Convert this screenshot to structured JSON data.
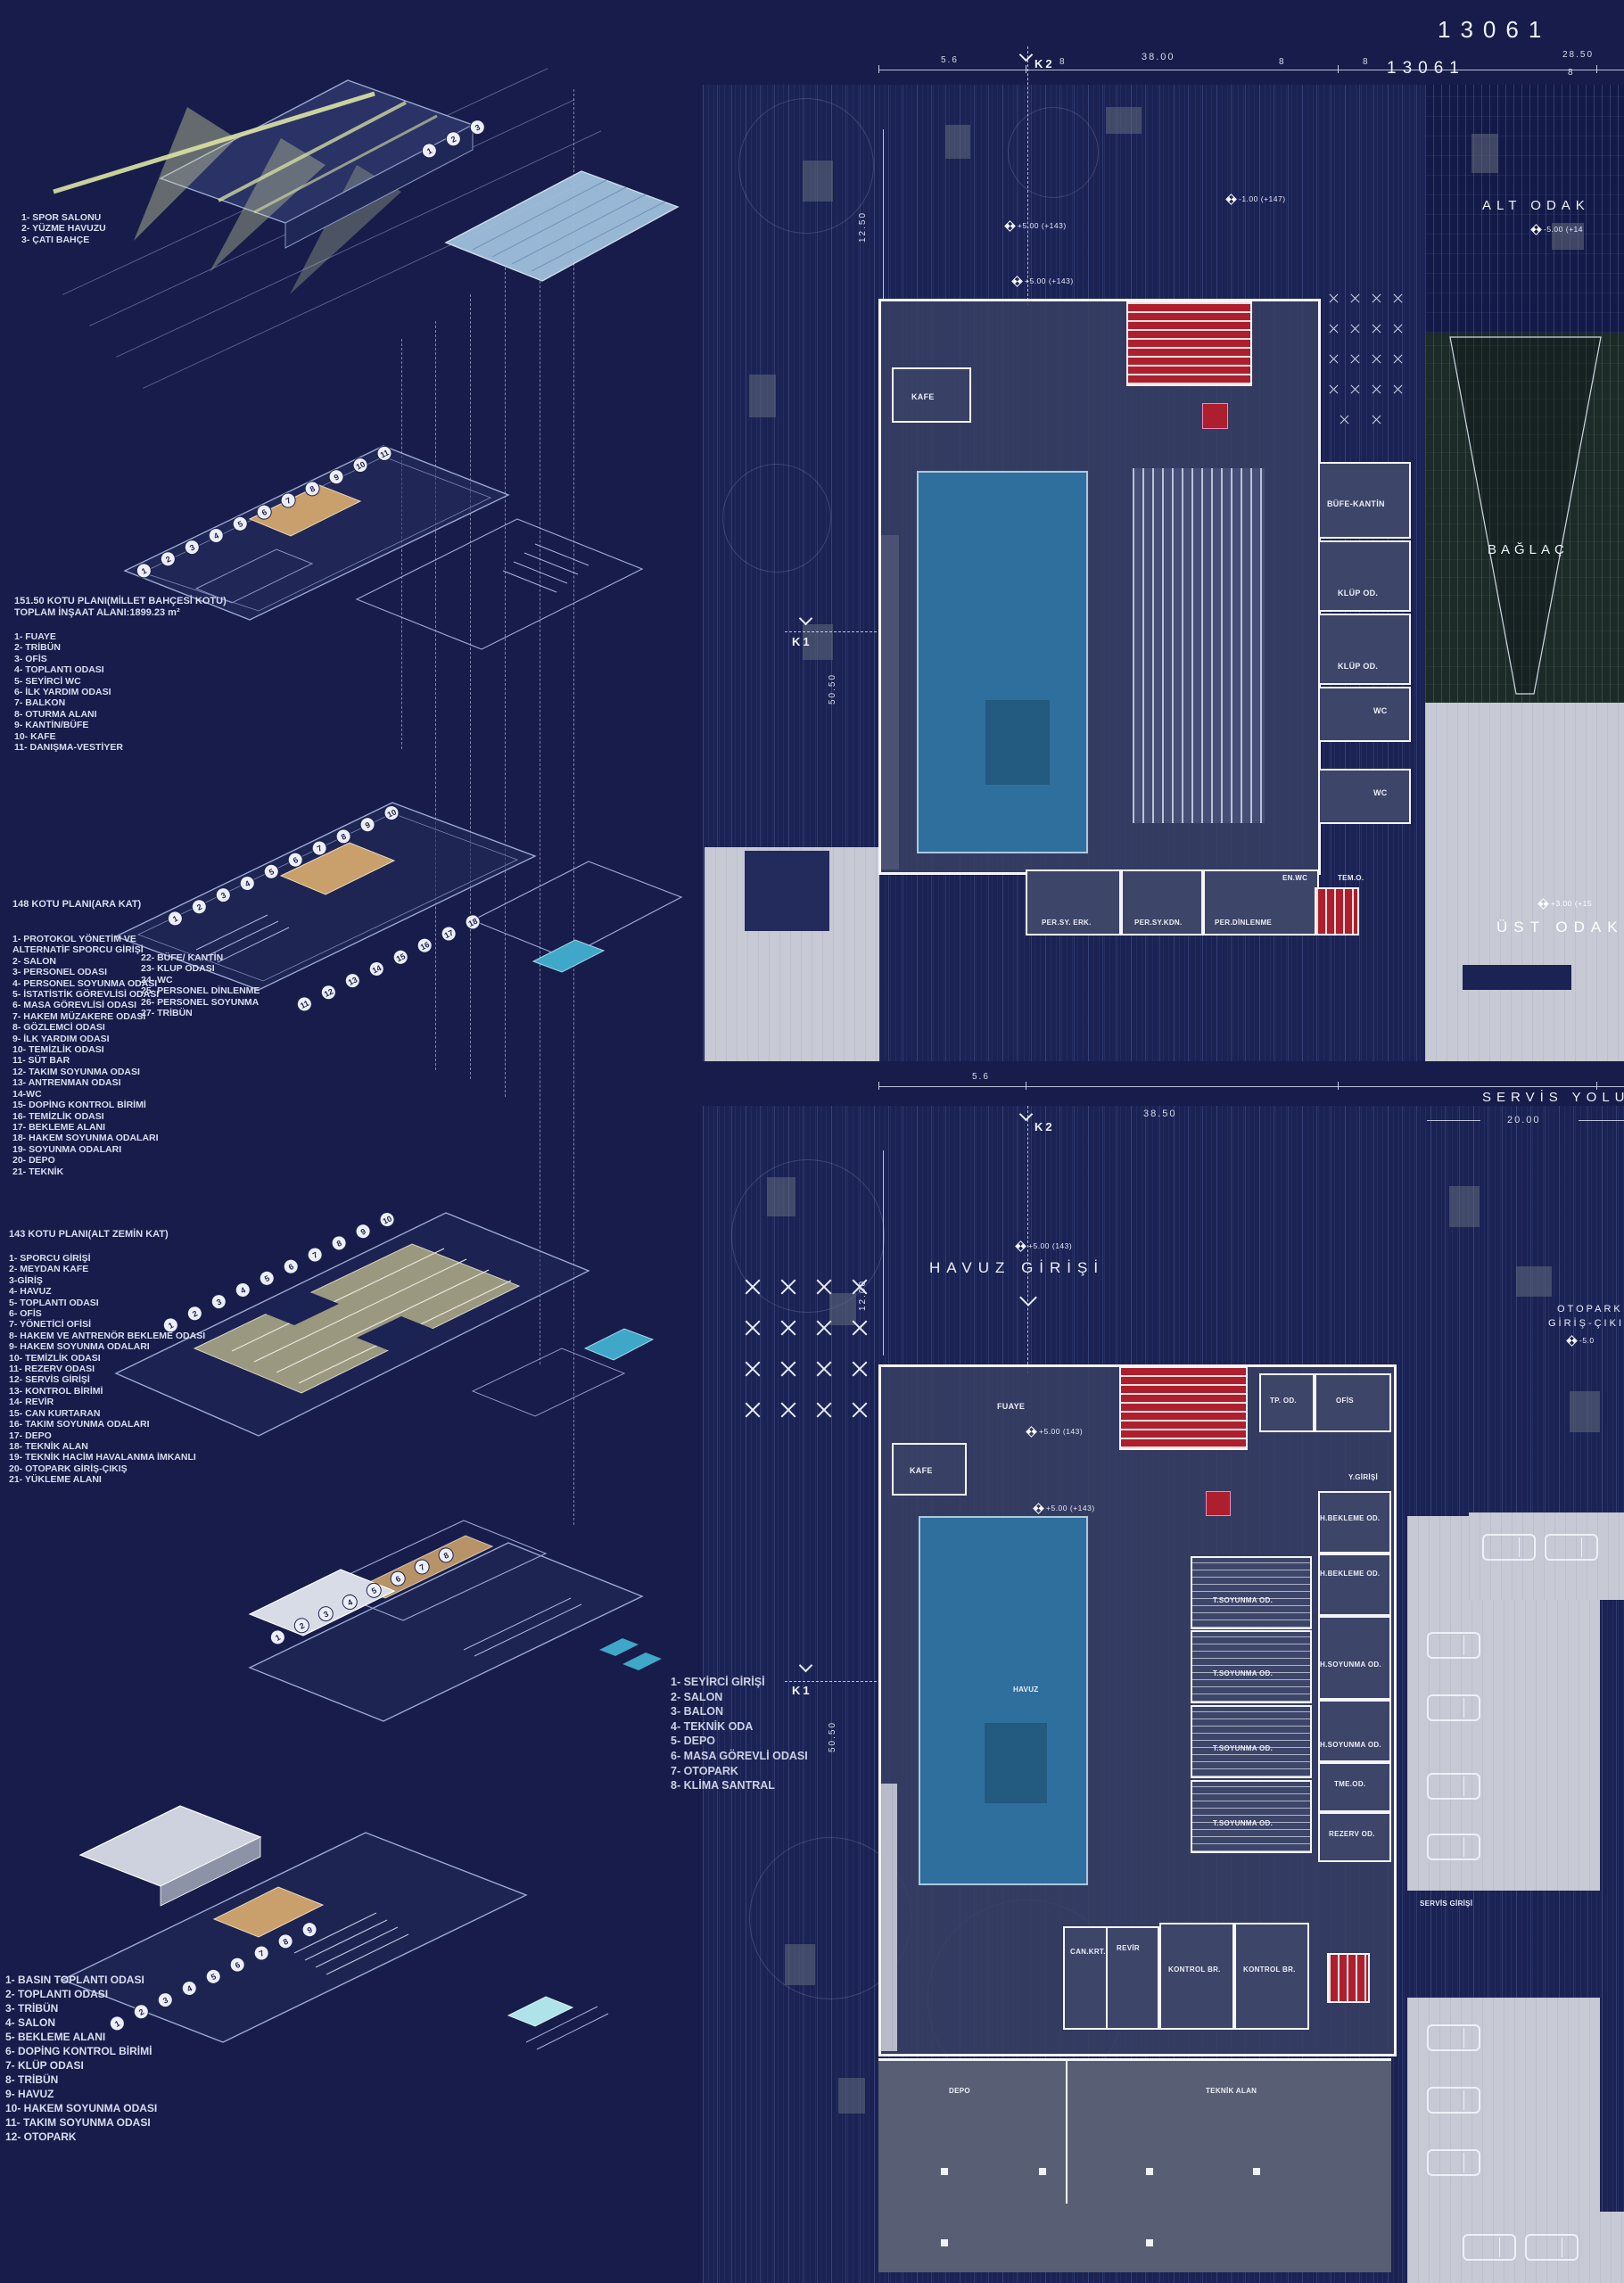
{
  "board": {
    "number_large": "13061",
    "number_small": "13061"
  },
  "icons": {
    "level_marker": "survey-diamond",
    "k_marker_arrow": "chevron-down",
    "tree": "cross-flower",
    "car": "car-outline"
  },
  "left": {
    "list_roof": [
      "1- SPOR SALONU",
      "2- YÜZME HAVUZU",
      "3- ÇATI BAHÇE"
    ],
    "list_151": {
      "title1": "151.50 KOTU PLANI(MİLLET BAHÇESİ KOTU)",
      "title2": "TOPLAM İNŞAAT ALANI:1899.23 m²",
      "items": [
        "1- FUAYE",
        "2- TRİBÜN",
        "3- OFİS",
        "4- TOPLANTI ODASI",
        "5- SEYİRCİ WC",
        "6- İLK YARDIM ODASI",
        "7- BALKON",
        "8- OTURMA ALANI",
        "9- KANTİN/BÜFE",
        "10- KAFE",
        "11- DANIŞMA-VESTİYER"
      ]
    },
    "list_148": {
      "title": "148 KOTU PLANI(ARA KAT)",
      "col1": [
        "1- PROTOKOL YÖNETİM VE",
        "ALTERNATİF SPORCU GİRİŞİ",
        "2- SALON",
        "3- PERSONEL ODASI",
        "4- PERSONEL SOYUNMA ODASI",
        "5- İSTATİSTİK GÖREVLİSİ ODASI",
        "6- MASA GÖREVLİSİ ODASI",
        "7- HAKEM MÜZAKERE ODASI",
        "8- GÖZLEMCİ ODASI",
        "9- İLK YARDIM ODASI",
        "10- TEMİZLİK ODASI",
        "11- SÜT BAR",
        "12- TAKIM SOYUNMA ODASI",
        "13- ANTRENMAN ODASI",
        "14-WC",
        "15- DOPİNG KONTROL BİRİMİ",
        "16- TEMİZLİK ODASI",
        "17- BEKLEME ALANI",
        "18- HAKEM SOYUNMA ODALARI",
        "19- SOYUNMA ODALARI",
        "20- DEPO",
        "21- TEKNİK"
      ],
      "col2": [
        "22- BÜFE/ KANTİN",
        "23- KLUP ODASI",
        "24- WC",
        "25- PERSONEL DİNLENME",
        "26- PERSONEL SOYUNMA",
        "27- TRİBÜN"
      ]
    },
    "list_143": {
      "title": "143 KOTU PLANI(ALT ZEMİN KAT)",
      "items": [
        "1- SPORCU GİRİŞİ",
        "2- MEYDAN KAFE",
        "3-GİRİŞ",
        "4- HAVUZ",
        "5- TOPLANTI ODASI",
        "6- OFİS",
        "7- YÖNETİCİ OFİSİ",
        "8- HAKEM VE ANTRENÖR BEKLEME ODASI",
        "9- HAKEM SOYUNMA ODALARI",
        "10- TEMİZLİK ODASI",
        "11- REZERV ODASI",
        "12-  SERVİS GİRİŞİ",
        "13- KONTROL BİRİMİ",
        "14- REVİR",
        "15- CAN KURTARAN",
        "16- TAKIM SOYUNMA ODALARI",
        "17- DEPO",
        "18- TEKNİK ALAN",
        "19- TEKNİK HACİM HAVALANMA İMKANLI",
        "20- OTOPARK GİRİŞ-ÇIKIŞ",
        "21- YÜKLEME ALANI"
      ]
    },
    "list_bottom": [
      "1- BASIN TOPLANTI ODASI",
      "2- TOPLANTI ODASI",
      "3- TRİBÜN",
      "4- SALON",
      "5- BEKLEME ALANI",
      "6- DOPİNG KONTROL BİRİMİ",
      "7- KLÜP ODASI",
      "8- TRİBÜN",
      "9- HAVUZ",
      "10- HAKEM SOYUNMA ODASI",
      "11- TAKIM SOYUNMA ODASI",
      "12- OTOPARK"
    ],
    "list_section": [
      "1- SEYİRCİ GİRİŞİ",
      "2- SALON",
      "3- BALON",
      "4- TEKNİK ODA",
      "5- DEPO",
      "6- MASA GÖREVLİ ODASI",
      "7- OTOPARK",
      "8- KLİMA SANTRAL"
    ]
  },
  "axons": {
    "a1": [
      "1",
      "2",
      "3"
    ],
    "a2": [
      "1",
      "2",
      "3",
      "4",
      "5",
      "6",
      "7",
      "8",
      "9",
      "10",
      "11"
    ],
    "a3r1": [
      "1",
      "2",
      "3",
      "4",
      "5",
      "6",
      "7",
      "8",
      "9",
      "10"
    ],
    "a3r2": [
      "11",
      "12",
      "13",
      "14",
      "15",
      "16",
      "17",
      "18"
    ],
    "a4": [
      "1",
      "2",
      "3",
      "4",
      "5",
      "6",
      "7",
      "8",
      "9",
      "10"
    ],
    "a5": [
      "1",
      "2",
      "3",
      "4",
      "5",
      "6",
      "7",
      "8"
    ],
    "a6": [
      "1",
      "2",
      "3",
      "4",
      "5",
      "6",
      "7",
      "8",
      "9"
    ]
  },
  "pt": {
    "dim_5_6": "5.6",
    "k2": "K2",
    "dim_38": "38.00",
    "dim_28_5": "28.50",
    "dim_12_5": "12.50",
    "k1": "K1",
    "dim_50_5": "50.50",
    "ticks": [
      "8",
      "8",
      "8"
    ],
    "tick_r": "8",
    "lv1": "+5.00 (+143)",
    "lv2": "+5.00 (+143)",
    "lv3": "-1.00 (+147)",
    "alt_odak": "ALT ODAK",
    "alt_level": "-5.00 (+14",
    "baglac": "BAĞLAÇ",
    "ust_odak": "ÜST ODAK",
    "ust_level": "+3.00 (+15",
    "rooms": {
      "kafe": "KAFE",
      "bufe": "BÜFE-KANTİN",
      "klup1": "KLÜP OD.",
      "klup2": "KLÜP OD.",
      "wc1": "WC",
      "wc2": "WC",
      "enwc": "EN.WC",
      "temo": "TEM.O.",
      "per1": "PER.SY. ERK.",
      "per2": "PER.SY.KDN.",
      "per3": "PER.DİNLENME"
    }
  },
  "pb": {
    "dim_5_6": "5.6",
    "k2": "K2",
    "dim_38_5": "38.50",
    "servis_yolu": "SERVİS YOLU",
    "dim_20": "20.00",
    "dim_12": "12.00",
    "k1": "K1",
    "dim_50_5": "50.50",
    "ticks": [
      "8",
      "8"
    ],
    "title": "HAVUZ GİRİŞİ",
    "lv1": "+5.00 (143)",
    "lv2": "+5.00 (143)",
    "lv3": "+5.00 (+143)",
    "lv4": "-5.0",
    "otopark1": "OTOPARK",
    "otopark2": "GİRİŞ-ÇIKIŞ",
    "rooms": {
      "fuaye": "FUAYE",
      "kafe": "KAFE",
      "tpod": "TP. OD.",
      "ofis": "OFİS",
      "ygirisi": "Y.GİRİŞİ",
      "havuz": "HAVUZ",
      "hbek1": "H.BEKLEME OD.",
      "hbek2": "H.BEKLEME OD.",
      "tsoy1": "T.SOYUNMA OD.",
      "tsoy2": "T.SOYUNMA OD.",
      "tsoy3": "T.SOYUNMA OD.",
      "tsoy4": "T.SOYUNMA OD.",
      "hsoy1": "H.SOYUNMA OD.",
      "hsoy2": "H.SOYUNMA OD.",
      "tme": "TME.OD.",
      "rezerv": "REZERV OD.",
      "servis": "SERVİS GİRİŞİ",
      "cankrt": "CAN.KRT.",
      "revir": "REVİR",
      "kontrol1": "KONTROL BR.",
      "kontrol2": "KONTROL BR.",
      "depo": "DEPO",
      "teknik": "TEKNİK ALAN"
    }
  },
  "colors": {
    "board_bg": "#171c4a",
    "plan_bg": "#1b2254",
    "light_gray": "#c7cad5",
    "wall_white": "#f4f5f9",
    "pool_blue": "#2f6f9d",
    "stair_red": "#ad1f2c",
    "court_tan": "#c9a06b",
    "glow_green": "#dce5a5",
    "roof_blue": "#9fc0dd"
  }
}
